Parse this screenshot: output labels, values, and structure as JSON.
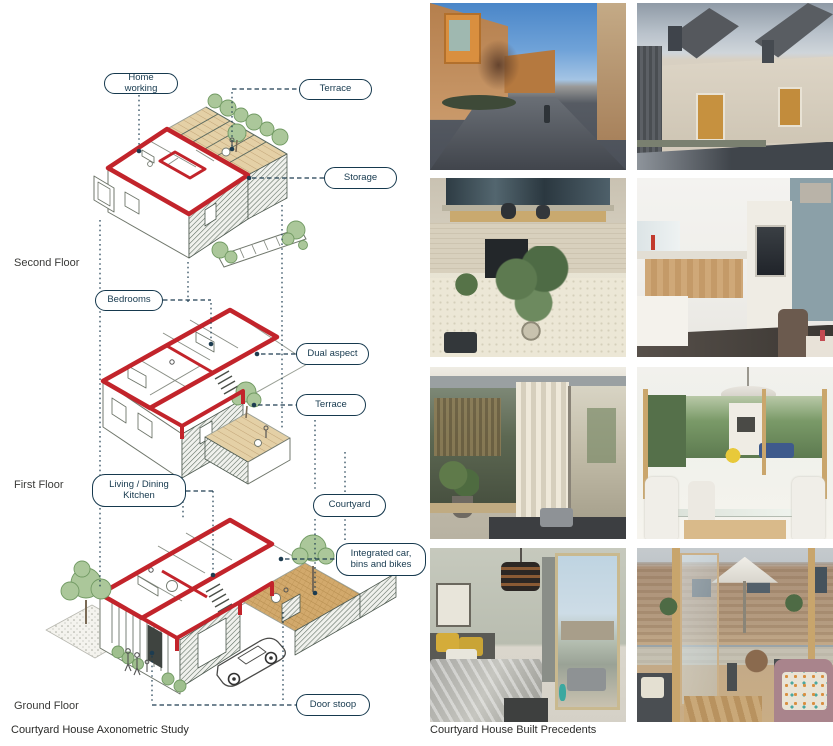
{
  "page": {
    "captions": {
      "axonometric": "Courtyard House Axonometric Study",
      "precedents": "Courtyard House Built Precedents"
    }
  },
  "diagram": {
    "floor_labels": [
      {
        "label": "Second Floor"
      },
      {
        "label": "First Floor"
      },
      {
        "label": "Ground Floor"
      }
    ],
    "callouts": [
      {
        "label": "Home working"
      },
      {
        "label": "Terrace"
      },
      {
        "label": "Storage"
      },
      {
        "label": "Bedrooms"
      },
      {
        "label": "Dual aspect"
      },
      {
        "label": "Terrace"
      },
      {
        "label": "Living / Dining Kitchen"
      },
      {
        "label": "Courtyard"
      },
      {
        "label": "Integrated car, bins and bikes"
      },
      {
        "label": "Door stoop"
      }
    ],
    "colors": {
      "section_outline_red": "#c2242b",
      "annotation_ink": "#16394e"
    }
  }
}
